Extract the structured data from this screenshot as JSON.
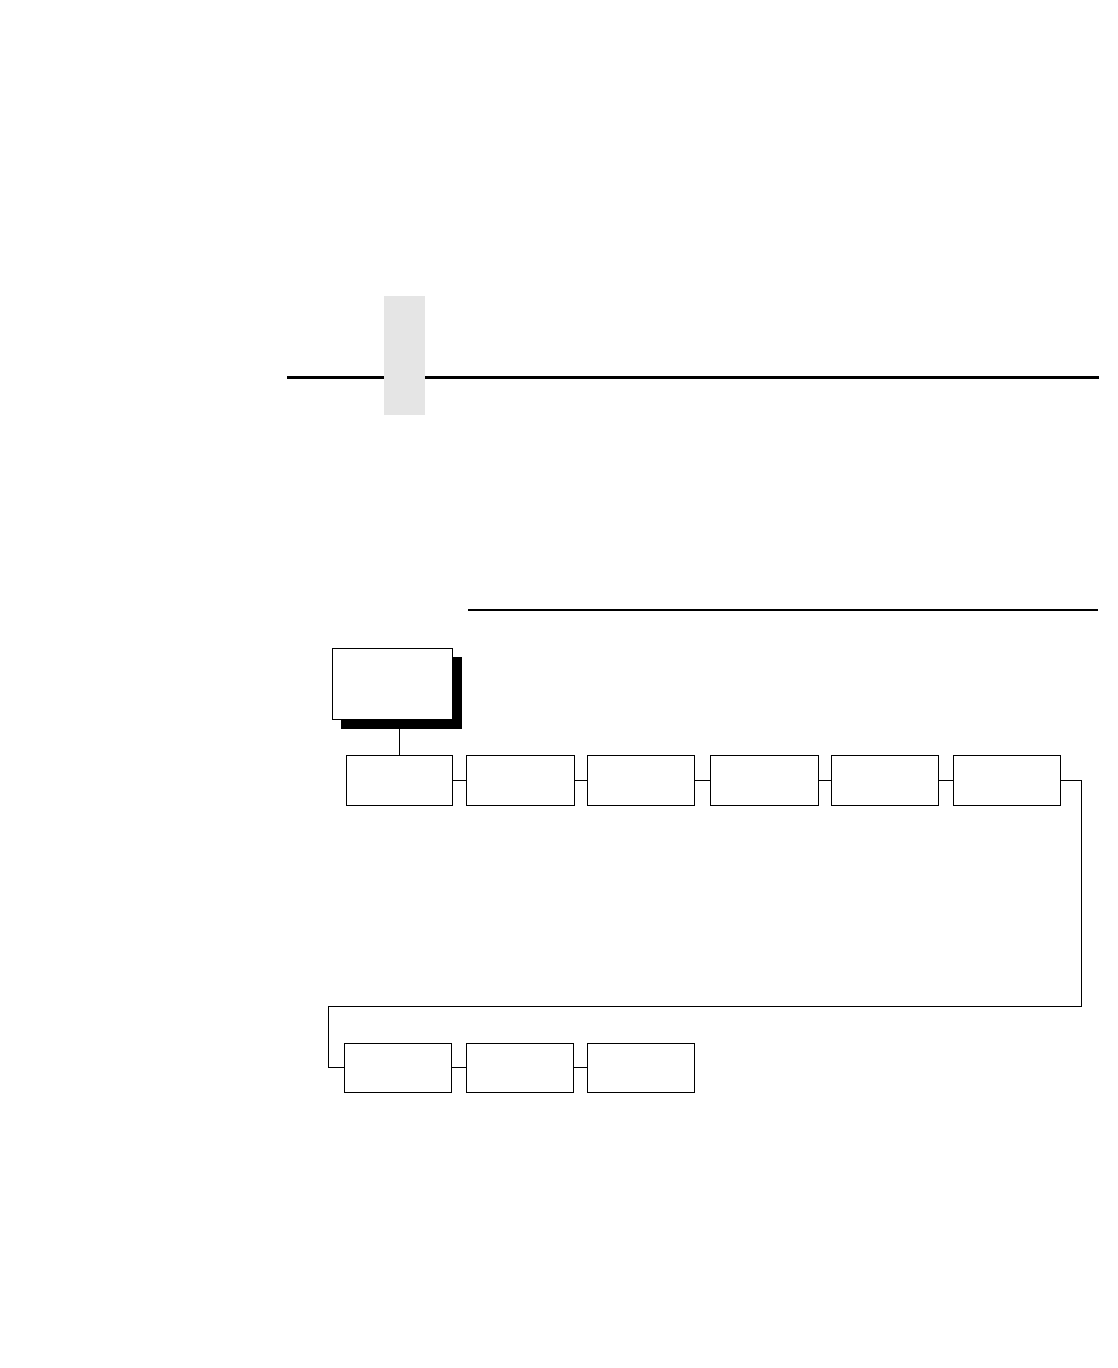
{
  "page": {
    "background_color": "#ffffff",
    "chapter_tab_color": "#e5e5e5",
    "line_color": "#000000"
  },
  "menu_diagram": {
    "root_box": {
      "label": ""
    },
    "row1_boxes": [
      {
        "label": ""
      },
      {
        "label": ""
      },
      {
        "label": ""
      },
      {
        "label": ""
      },
      {
        "label": ""
      },
      {
        "label": ""
      }
    ],
    "row2_boxes": [
      {
        "label": ""
      },
      {
        "label": ""
      },
      {
        "label": ""
      }
    ]
  }
}
